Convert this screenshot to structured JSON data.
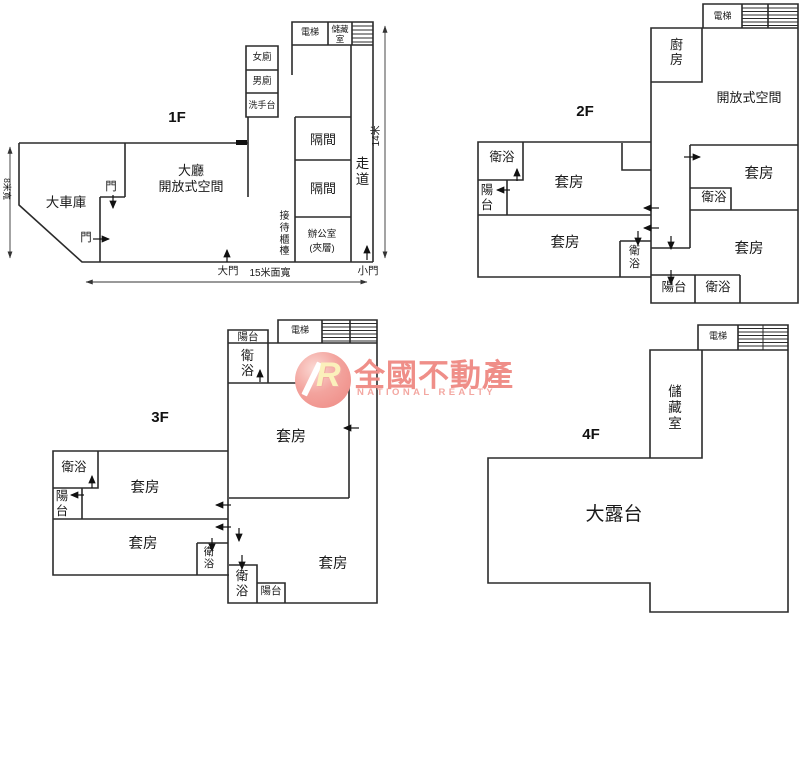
{
  "watermark": {
    "logo_letter": "R",
    "brand": "全國不動產",
    "brand_en": "NATIONAL REALTY",
    "brand_color": "#ef8e88"
  },
  "colors": {
    "wall": "#2b2b2b",
    "background": "#ffffff"
  },
  "f1": {
    "floor_label": "1F",
    "elevator": "電梯",
    "storage": "儲藏室",
    "toilet_female": "女廁",
    "toilet_male": "男廁",
    "washbasin": "洗手台",
    "lobby_line1": "大廳",
    "lobby_line2": "開放式空間",
    "garage": "大車庫",
    "door_a": "門",
    "door_b": "門",
    "partition_1": "隔間",
    "partition_2": "隔間",
    "office_line1": "辦公室",
    "office_line2": "(夾層)",
    "corridor": "走道",
    "reception_desk": "接待櫃檯",
    "main_door": "大門",
    "small_door": "小門",
    "dim_width": "15米面寬",
    "dim_height": "14米",
    "dim_depth": "8米寬"
  },
  "f2": {
    "floor_label": "2F",
    "elevator": "電梯",
    "kitchen": "廚房",
    "open_space": "開放式空間",
    "bath_left": "衛浴",
    "balcony_left": "陽台",
    "suite_upper_left": "套房",
    "suite_lower_left": "套房",
    "bath_center": "衛浴",
    "suite_upper_right": "套房",
    "bath_right": "衛浴",
    "suite_lower_right": "套房",
    "balcony_bottom": "陽台",
    "bath_bottom": "衛浴"
  },
  "f3": {
    "floor_label": "3F",
    "balcony_top": "陽台",
    "elevator": "電梯",
    "bath_top": "衛浴",
    "suite_main": "套房",
    "bath_left": "衛浴",
    "suite_upper_left": "套房",
    "balcony_left": "陽台",
    "suite_lower_left": "套房",
    "bath_center_1": "衛浴",
    "bath_center_2": "衛浴",
    "balcony_bottom": "陽台",
    "suite_lower_right": "套房"
  },
  "f4": {
    "floor_label": "4F",
    "elevator": "電梯",
    "storage": "儲藏室",
    "terrace": "大露台"
  }
}
